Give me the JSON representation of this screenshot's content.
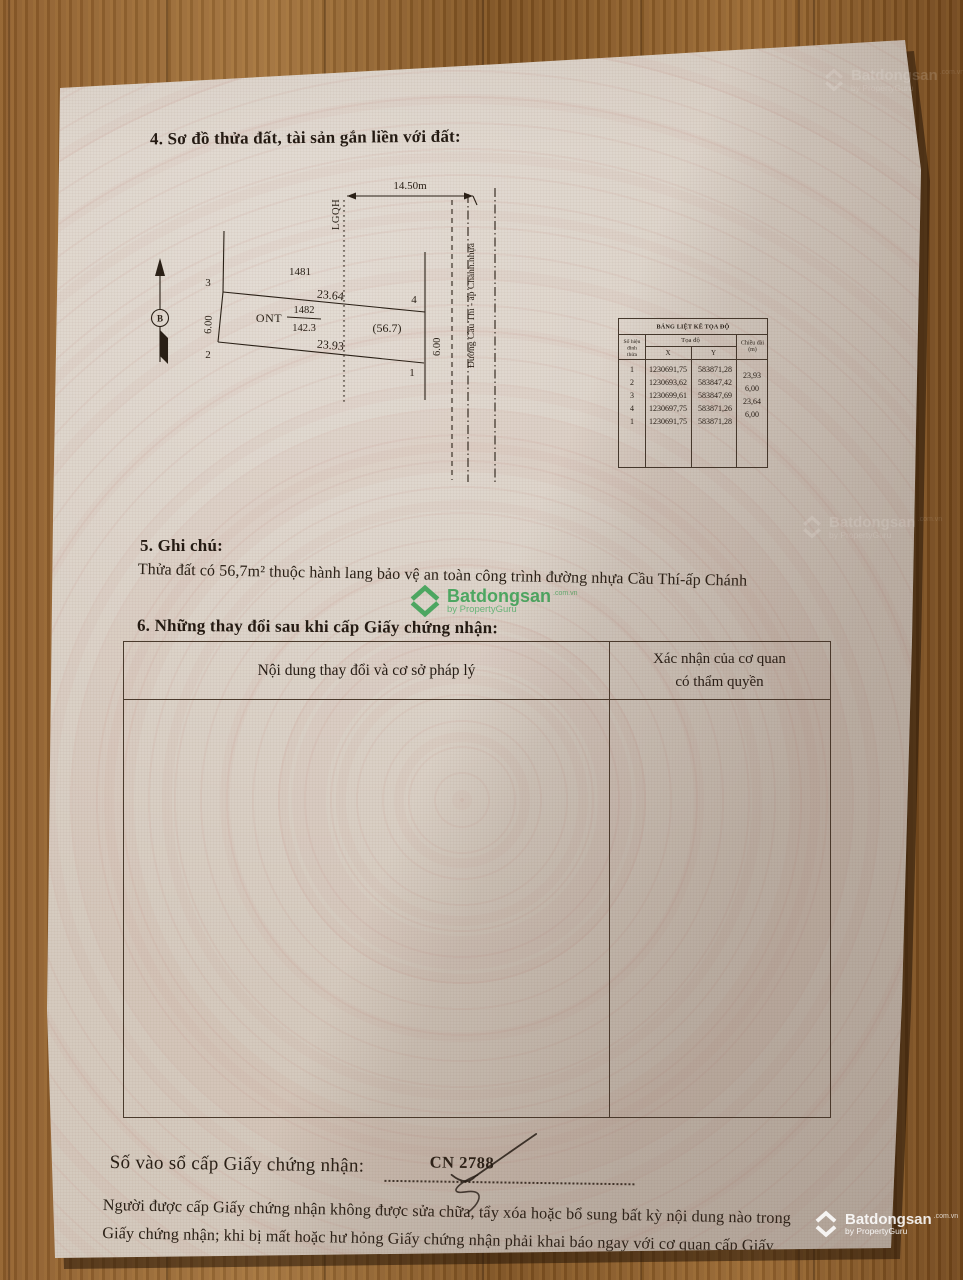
{
  "brand": {
    "name": "Batdongsan",
    "domain": ".com.vn",
    "byline": "by PropertyGuru"
  },
  "section4": {
    "title": "4. Sơ đồ thửa đất, tài sản gắn liền với đất:"
  },
  "diagram": {
    "north_label": "B",
    "planning_boundary_label": "LGQH",
    "road_width_label": "14.50m",
    "road_name": "Đường Cầu Thí - ấp Chánh.nhựa",
    "adjacent_parcel_number": "1481",
    "parcel_number": "1482",
    "parcel_area": "142.3",
    "land_use_code": "ONT",
    "easement_area": "(56.7)",
    "edge_top_length": "23.64",
    "edge_bottom_length": "23.93",
    "edge_left_length": "6.00",
    "edge_right_length": "6.00",
    "vertices": [
      "1",
      "2",
      "3",
      "4"
    ]
  },
  "coord_table": {
    "title": "BẢNG LIỆT KÊ TỌA ĐỘ",
    "col_vertex": "Số hiệu đỉnh thửa",
    "col_coords": "Tọa độ",
    "col_x": "X",
    "col_y": "Y",
    "col_length": "Chiều dài (m)",
    "rows": [
      {
        "v": "1",
        "x": "1230691,75",
        "y": "583871,28"
      },
      {
        "v": "2",
        "x": "1230693,62",
        "y": "583847,42"
      },
      {
        "v": "3",
        "x": "1230699,61",
        "y": "583847,69"
      },
      {
        "v": "4",
        "x": "1230697,75",
        "y": "583871,26"
      },
      {
        "v": "1",
        "x": "1230691,75",
        "y": "583871,28"
      }
    ],
    "lengths": [
      "23,93",
      "6,00",
      "23,64",
      "6,00"
    ]
  },
  "section5": {
    "title": "5. Ghi chú:",
    "note": "Thửa đất có 56,7m² thuộc hành lang bảo vệ an toàn công trình đường nhựa Cầu Thí-ấp Chánh"
  },
  "section6": {
    "title": "6. Những thay đổi sau khi cấp Giấy chứng nhận:",
    "col_left": "Nội dung thay đổi và cơ sở pháp lý",
    "col_right_line1": "Xác nhận của cơ quan",
    "col_right_line2": "có thẩm quyền"
  },
  "footer": {
    "registry_label": "Số vào sổ cấp Giấy chứng nhận:",
    "registry_number": "CN 2788",
    "notice_line1": "Người được cấp Giấy chứng nhận không được sửa chữa, tẩy xóa hoặc bổ sung bất kỳ nội dung nào trong",
    "notice_line2": "Giấy chứng nhận; khi bị mất hoặc hư hỏng Giấy chứng nhận phải khai báo ngay với cơ quan cấp Giấy."
  },
  "colors": {
    "brand_green": "#2f9e4c",
    "paper": "#d8cec3",
    "ink": "#2a2016"
  }
}
